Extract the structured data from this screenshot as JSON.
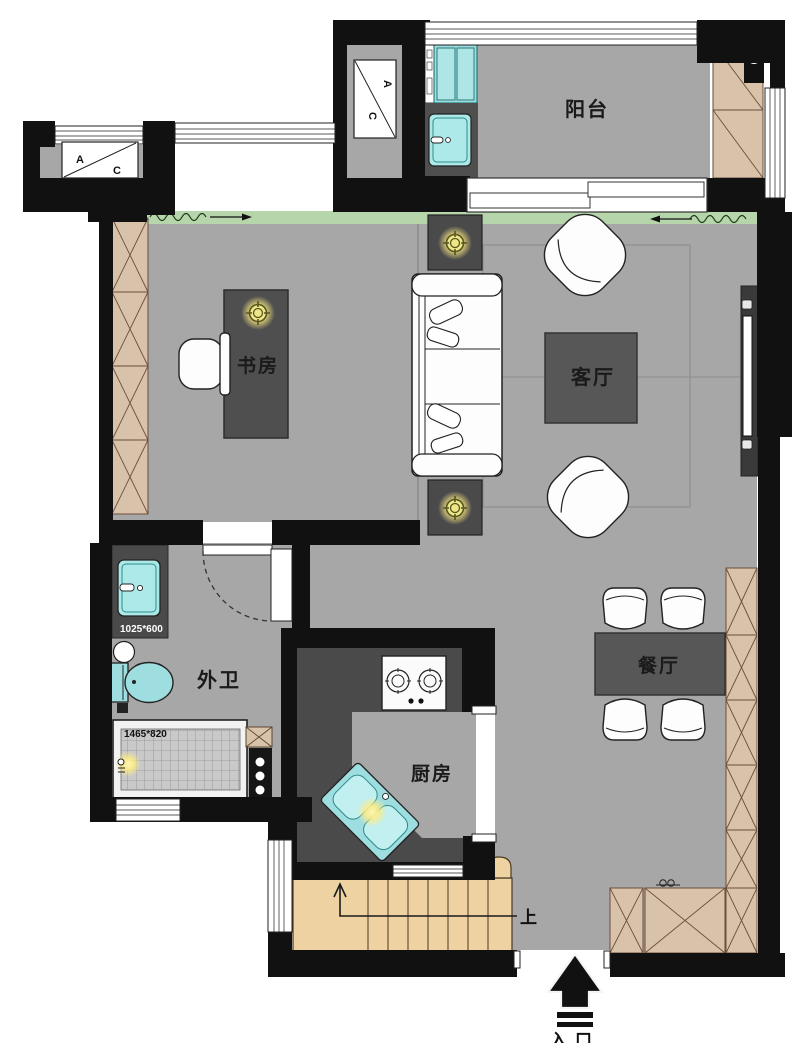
{
  "plan": {
    "rooms": {
      "balcony": "阳台",
      "study": "书房",
      "living_room": "客厅",
      "bathroom": "外卫",
      "kitchen": "厨房",
      "dining_room": "餐厅"
    },
    "annotations": {
      "stairs_up": "上",
      "entrance": "入口",
      "ac_top": "A",
      "ac_bottom": "C",
      "vanity_size": "1025*600",
      "shower_size": "1465*820"
    },
    "colors": {
      "wall": "#111111",
      "floor": "#a7a7a7",
      "dark_furniture": "#555555",
      "counter": "#4a4a4a",
      "fixture_cyan": "#9fdee0",
      "cabinet_tan": "#d9c2aa",
      "stairs_tan": "#eed2a2",
      "curtain_green": "#b7d5aa",
      "lamp_glow": "#ffec85"
    }
  }
}
